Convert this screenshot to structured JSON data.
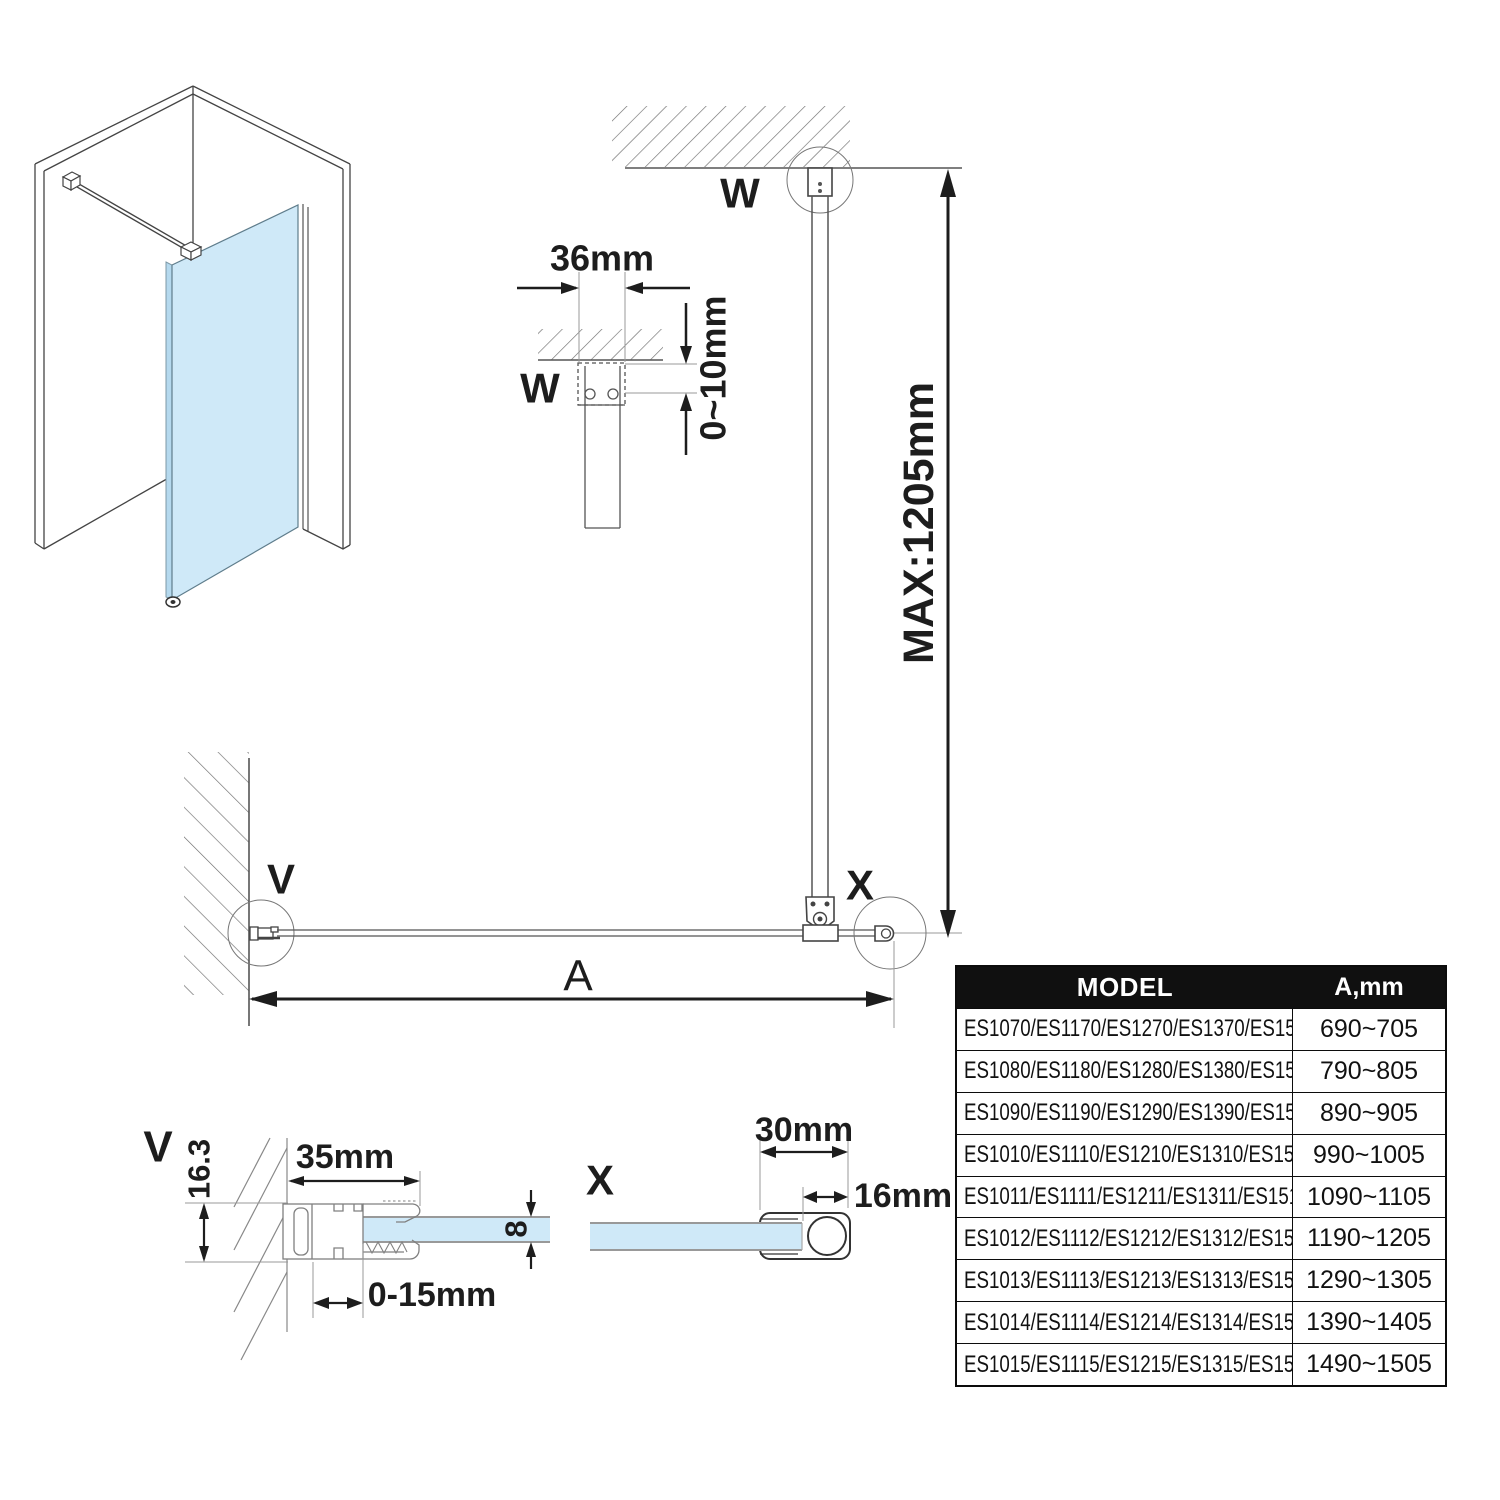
{
  "colors": {
    "glass_fill": "#cfe9f8",
    "glass_side_fill": "#b5d9ee",
    "glass_edge": "#999999",
    "drawing_line": "#444444",
    "profile_line": "#808080",
    "dimension_line": "#1d1d1d",
    "table_header_bg": "#101010",
    "table_header_text": "#ffffff"
  },
  "detail_w": {
    "label": "W",
    "width_dim": "36mm",
    "offset_dim": "0~10mm"
  },
  "elevation": {
    "wall_bracket_label": "W",
    "max_height_dim": "MAX:1205mm",
    "corner_label": "X"
  },
  "plan": {
    "wall_label": "V",
    "length_dim": "A"
  },
  "detail_v": {
    "label": "V",
    "profile_height_dim": "16.3",
    "profile_width_dim": "35mm",
    "adjust_range_dim": "0-15mm",
    "glass_thickness_dim": "8"
  },
  "detail_x": {
    "label": "X",
    "profile_width_dim": "30mm",
    "tube_dim": "16mm"
  },
  "table": {
    "header": {
      "model": "MODEL",
      "a": "A,mm"
    },
    "rows": [
      {
        "model": "ES1070/ES1170/ES1270/ES1370/ES1570",
        "a": "690~705"
      },
      {
        "model": "ES1080/ES1180/ES1280/ES1380/ES1580",
        "a": "790~805"
      },
      {
        "model": "ES1090/ES1190/ES1290/ES1390/ES1590",
        "a": "890~905"
      },
      {
        "model": "ES1010/ES1110/ES1210/ES1310/ES1510",
        "a": "990~1005"
      },
      {
        "model": "ES1011/ES1111/ES1211/ES1311/ES1511",
        "a": "1090~1105"
      },
      {
        "model": "ES1012/ES1112/ES1212/ES1312/ES1512",
        "a": "1190~1205"
      },
      {
        "model": "ES1013/ES1113/ES1213/ES1313/ES1513",
        "a": "1290~1305"
      },
      {
        "model": "ES1014/ES1114/ES1214/ES1314/ES1514",
        "a": "1390~1405"
      },
      {
        "model": "ES1015/ES1115/ES1215/ES1315/ES1515",
        "a": "1490~1505"
      }
    ]
  }
}
